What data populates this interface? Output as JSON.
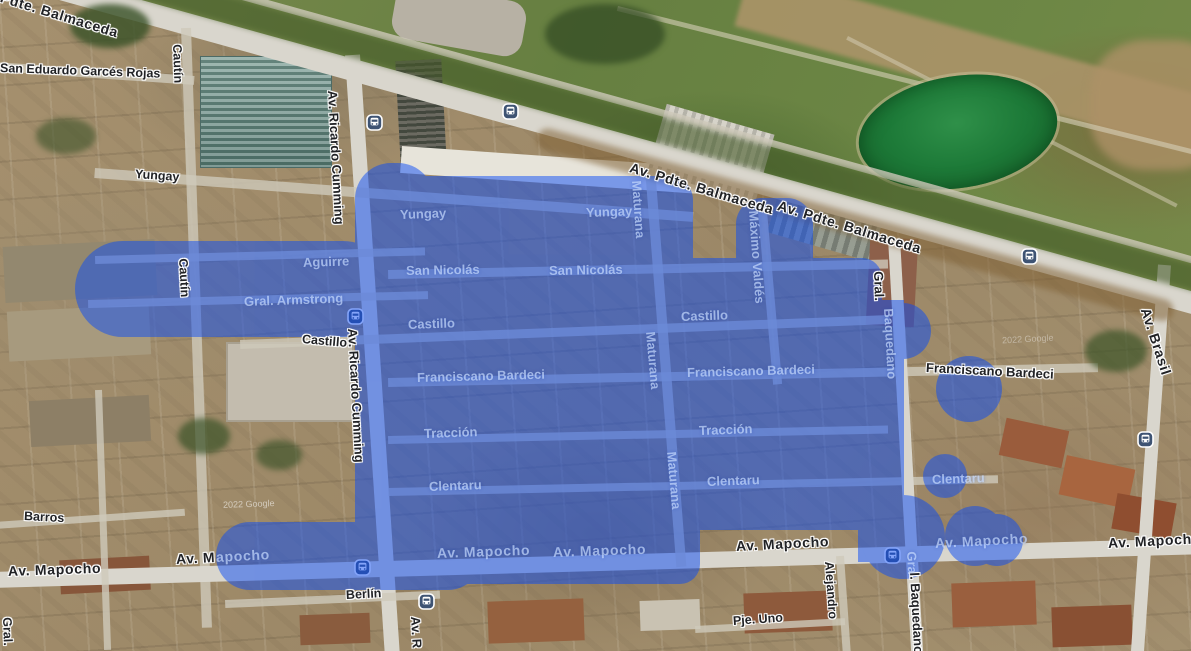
{
  "map_type": "satellite-map-with-region-overlay",
  "overlay": {
    "color": "#0b4cf6",
    "opacity": "0.5",
    "name": "painted-selection-region"
  },
  "watermark": "2022 Google",
  "transit_icon": {
    "glyph": "bus",
    "shape": "rounded-square",
    "color": "#3e5373"
  },
  "labels": {
    "dark": [
      "Av. Pdte. Balmaceda",
      "San Eduardo Garcés Rojas",
      "Cautín",
      "Yungay",
      "Av. Ricardo Cumming",
      "Cautín",
      "Castillo",
      "Av. Ricardo Cumming",
      "Av. Pdte. Balmaceda",
      "Av. Pdte. Balmaceda",
      "Gral.",
      "Franciscano Bardeci",
      "Av. Brasil",
      "Barros",
      "Av. Mapocho",
      "Av. M",
      "Av. Mapocho",
      "Av. Mapocho",
      "Berlín",
      "Pje. Uno",
      "Alejandro",
      "l. Baquedano",
      "Gral.",
      "Av. R"
    ],
    "light": [
      "Yungay",
      "Yungay",
      "San Nicolás",
      "San Nicolás",
      "Aguirre",
      "Gral. Armstrong",
      "Castillo",
      "Castillo",
      "Franciscano Bardeci",
      "Franciscano Bardeci",
      "Tracción",
      "Tracción",
      "Clentaru",
      "Clentaru",
      "Clentaru",
      "Av. Mapocho",
      "Av. Mapocho",
      "Av. Mapocho",
      "apocho",
      "Maturana",
      "Maturana",
      "Maturana",
      "Máximo Valdés",
      "Baquedano",
      "Gra"
    ]
  }
}
